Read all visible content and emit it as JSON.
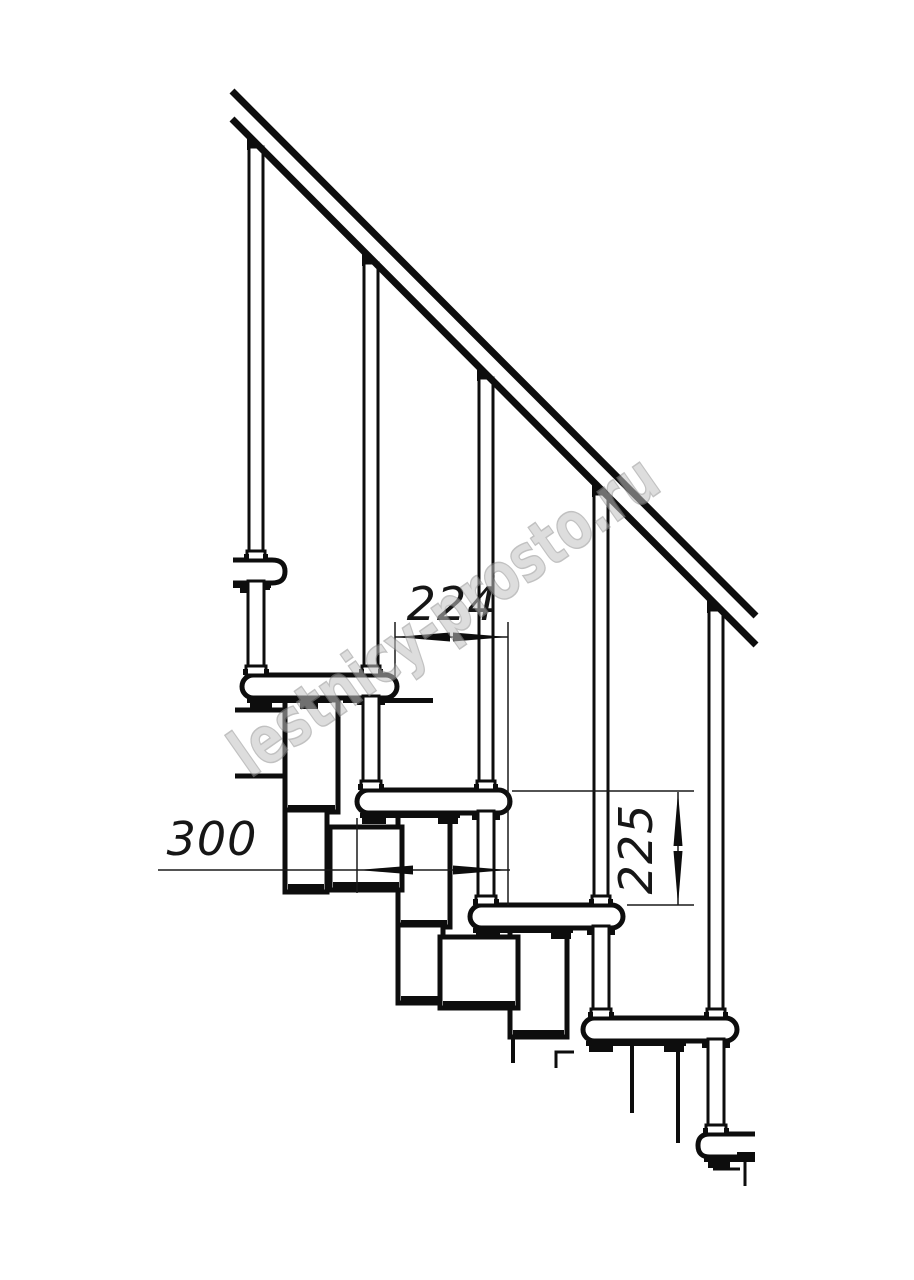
{
  "figure": {
    "type": "technical-drawing",
    "subject": "modular staircase side view with handrail",
    "background": "#ffffff",
    "ink": "#0d0d0d",
    "baluster_count": 5,
    "tread_count": 6
  },
  "watermark": {
    "text": "lestnicy-prosto.ru",
    "fill": "#c2c2c2",
    "outline": "#8f8f8f"
  },
  "dimensions": [
    {
      "label": "224",
      "value": 224,
      "orientation": "horizontal",
      "measures": "step run between tread noses"
    },
    {
      "label": "300",
      "value": 300,
      "orientation": "horizontal",
      "measures": "tread depth"
    },
    {
      "label": "225",
      "value": 225,
      "orientation": "vertical",
      "measures": "riser height between treads"
    }
  ]
}
